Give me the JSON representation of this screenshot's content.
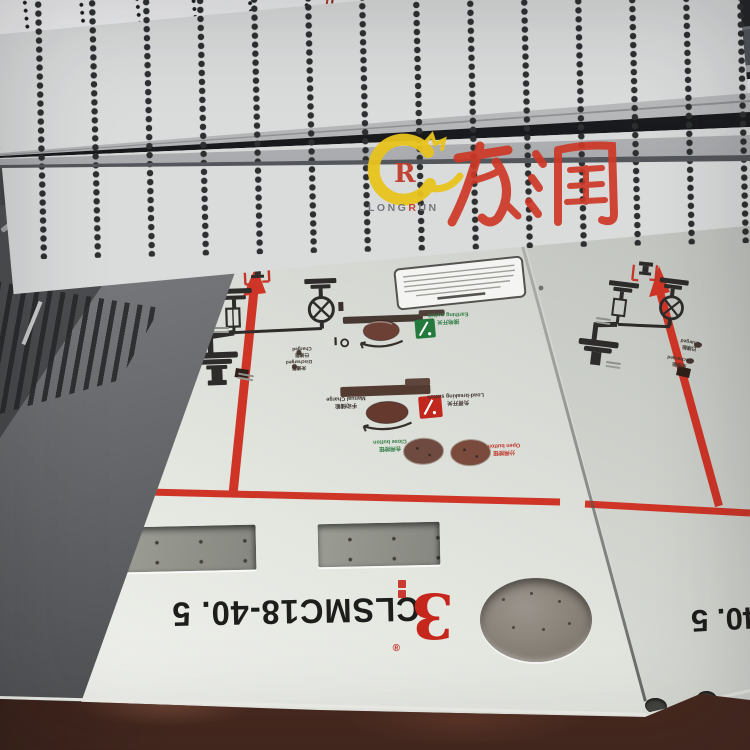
{
  "watermark": {
    "logo_text_en_pre": "LONG",
    "logo_text_en_r": "R",
    "logo_text_en_post": "UN",
    "logo_monogram": "R",
    "logo_text_cn": "龙润"
  },
  "panel_prints": {
    "model_left": "CLSMC18-40. 5",
    "model_right_partial": "40. 5",
    "brand_glyph": "3",
    "brand_registered": "®",
    "labels": {
      "earthing_switch_cn": "接地开关",
      "earthing_switch_en": "Earthing switch",
      "load_switch_cn": "负荷开关",
      "load_switch_en": "Load-breaking switch",
      "manual_charge_cn": "手动储能",
      "manual_charge_en": "Manual Charge",
      "close_button_cn": "合闸按钮",
      "close_button_en": "Close button",
      "open_button_cn": "分闸按钮",
      "open_button_en": "Open button",
      "charged_cn": "已储能",
      "charged_en": "Charged",
      "discharged_cn": "未储能",
      "discharged_en": "Discharged"
    }
  },
  "colors": {
    "print_red": "#cf3527",
    "print_black": "#33302c",
    "indicator_green": "#237a3c",
    "indicator_red": "#c1271d",
    "watermark_yellow": "#e8c41e",
    "watermark_red": "#cf3826"
  }
}
